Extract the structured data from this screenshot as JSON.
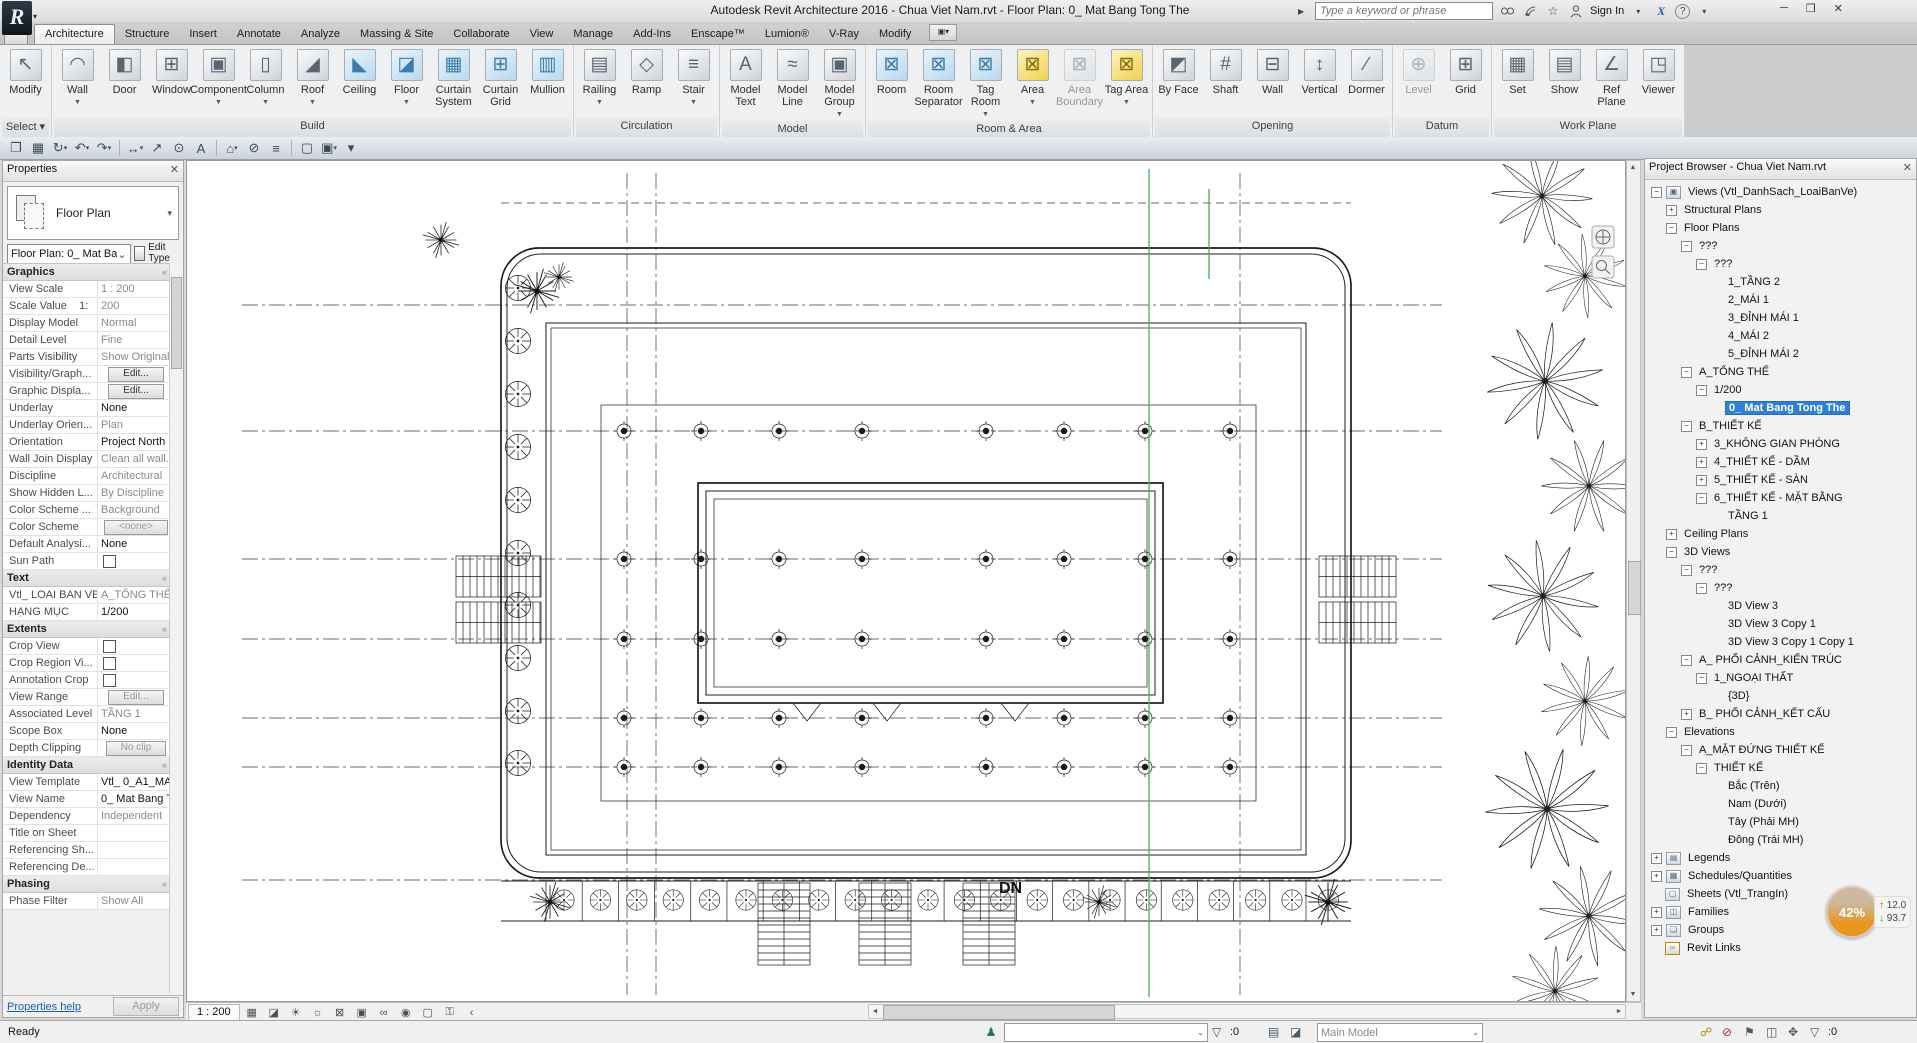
{
  "window": {
    "title": "Autodesk Revit Architecture 2016 -    Chua Viet Nam.rvt - Floor Plan: 0_ Mat Bang Tong The",
    "app_button": "R",
    "app_button_small": "A",
    "search_placeholder": "Type a keyword or phrase",
    "sign_in": "Sign In",
    "exchange_label": "X",
    "help_label": "?",
    "minimize": "─",
    "restore": "❐",
    "close": "✕"
  },
  "tabs": [
    {
      "label": "Architecture",
      "active": true
    },
    {
      "label": "Structure"
    },
    {
      "label": "Insert"
    },
    {
      "label": "Annotate"
    },
    {
      "label": "Analyze"
    },
    {
      "label": "Massing & Site"
    },
    {
      "label": "Collaborate"
    },
    {
      "label": "View"
    },
    {
      "label": "Manage"
    },
    {
      "label": "Add-Ins"
    },
    {
      "label": "Enscape™"
    },
    {
      "label": "Lumion®"
    },
    {
      "label": "V-Ray"
    },
    {
      "label": "Modify"
    }
  ],
  "qat": [
    {
      "name": "open-icon",
      "glyph": "❐"
    },
    {
      "name": "save-icon",
      "glyph": "▦"
    },
    {
      "name": "sync-icon",
      "glyph": "↻",
      "arrow": true
    },
    {
      "name": "undo-icon",
      "glyph": "↶",
      "arrow": true
    },
    {
      "name": "redo-icon",
      "glyph": "↷",
      "arrow": true
    },
    {
      "name": "measure-icon",
      "glyph": "↔",
      "arrow": true
    },
    {
      "name": "aligned-dimension-icon",
      "glyph": "↗"
    },
    {
      "name": "tag-icon",
      "glyph": "⊙"
    },
    {
      "name": "text-icon",
      "glyph": "A"
    },
    {
      "name": "default-3d-view-icon",
      "glyph": "⌂",
      "arrow": true
    },
    {
      "name": "section-icon",
      "glyph": "⊘"
    },
    {
      "name": "thin-lines-icon",
      "glyph": "≡"
    },
    {
      "name": "close-hidden-windows-icon",
      "glyph": "▢"
    },
    {
      "name": "switch-windows-icon",
      "glyph": "▣",
      "arrow": true
    },
    {
      "name": "customize-qat-icon",
      "glyph": "▾"
    }
  ],
  "ribbon": {
    "groups": [
      {
        "label": "Select",
        "arrow": true,
        "buttons": [
          {
            "label": "Modify",
            "glyph": "↖"
          }
        ]
      },
      {
        "label": "Build",
        "buttons": [
          {
            "label": "Wall",
            "glyph": "◠",
            "arrow": true
          },
          {
            "label": "Door",
            "glyph": "◧"
          },
          {
            "label": "Window",
            "glyph": "⊞"
          },
          {
            "label": "Component",
            "glyph": "▣",
            "arrow": true
          },
          {
            "label": "Column",
            "glyph": "▯",
            "arrow": true
          },
          {
            "label": "Roof",
            "glyph": "◢",
            "arrow": true
          },
          {
            "label": "Ceiling",
            "glyph": "◣",
            "tone": "blue"
          },
          {
            "label": "Floor",
            "glyph": "◪",
            "tone": "blue",
            "arrow": true
          },
          {
            "label": "Curtain System",
            "glyph": "▦",
            "tone": "blue"
          },
          {
            "label": "Curtain Grid",
            "glyph": "⊞",
            "tone": "blue"
          },
          {
            "label": "Mullion",
            "glyph": "▥",
            "tone": "blue"
          }
        ]
      },
      {
        "label": "Circulation",
        "buttons": [
          {
            "label": "Railing",
            "glyph": "▤",
            "arrow": true
          },
          {
            "label": "Ramp",
            "glyph": "◇"
          },
          {
            "label": "Stair",
            "glyph": "≡",
            "arrow": true
          }
        ]
      },
      {
        "label": "Model",
        "buttons": [
          {
            "label": "Model Text",
            "glyph": "A"
          },
          {
            "label": "Model Line",
            "glyph": "≈"
          },
          {
            "label": "Model Group",
            "glyph": "▣",
            "arrow": true
          }
        ]
      },
      {
        "label": "Room & Area",
        "buttons": [
          {
            "label": "Room",
            "glyph": "⊠",
            "tone": "blue"
          },
          {
            "label": "Room Separator",
            "glyph": "⊠",
            "tone": "blue"
          },
          {
            "label": "Tag Room",
            "glyph": "⊠",
            "tone": "blue",
            "arrow": true
          },
          {
            "label": "Area",
            "glyph": "⊠",
            "tone": "yellow",
            "arrow": true
          },
          {
            "label": "Area Boundary",
            "glyph": "⊠",
            "disabled": true
          },
          {
            "label": "Tag Area",
            "glyph": "⊠",
            "tone": "yellow",
            "arrow": true
          }
        ]
      },
      {
        "label": "Opening",
        "buttons": [
          {
            "label": "By Face",
            "glyph": "◩"
          },
          {
            "label": "Shaft",
            "glyph": "#"
          },
          {
            "label": "Wall",
            "glyph": "⊟"
          },
          {
            "label": "Vertical",
            "glyph": "↕"
          },
          {
            "label": "Dormer",
            "glyph": "∕"
          }
        ]
      },
      {
        "label": "Datum",
        "buttons": [
          {
            "label": "Level",
            "glyph": "⊕",
            "disabled": true
          },
          {
            "label": "Grid",
            "glyph": "⊞"
          }
        ]
      },
      {
        "label": "Work Plane",
        "buttons": [
          {
            "label": "Set",
            "glyph": "▦"
          },
          {
            "label": "Show",
            "glyph": "▤"
          },
          {
            "label": "Ref Plane",
            "glyph": "∠"
          },
          {
            "label": "Viewer",
            "glyph": "◳"
          }
        ]
      }
    ]
  },
  "properties": {
    "title": "Properties",
    "close": "✕",
    "type_label": "Floor Plan",
    "selector": "Floor Plan: 0_ Mat Ba",
    "selector_arrow": "⌄",
    "edit_type": "Edit Type",
    "help": "Properties help",
    "apply": "Apply",
    "sections": [
      {
        "header": "Graphics",
        "rows": [
          {
            "label": "View Scale",
            "value": "1 : 200",
            "muted": true
          },
          {
            "label": "Scale Value    1:",
            "value": "200",
            "muted": true
          },
          {
            "label": "Display Model",
            "value": "Normal",
            "muted": true
          },
          {
            "label": "Detail Level",
            "value": "Fine",
            "muted": true
          },
          {
            "label": "Parts Visibility",
            "value": "Show Original",
            "muted": true
          },
          {
            "label": "Visibility/Graph...",
            "value": "Edit...",
            "type": "button"
          },
          {
            "label": "Graphic Displa...",
            "value": "Edit...",
            "type": "button"
          },
          {
            "label": "Underlay",
            "value": "None"
          },
          {
            "label": "Underlay Orien...",
            "value": "Plan",
            "muted": true
          },
          {
            "label": "Orientation",
            "value": "Project North"
          },
          {
            "label": "Wall Join Display",
            "value": "Clean all wall...",
            "muted": true
          },
          {
            "label": "Discipline",
            "value": "Architectural",
            "muted": true
          },
          {
            "label": "Show Hidden L...",
            "value": "By Discipline",
            "muted": true
          },
          {
            "label": "Color Scheme ...",
            "value": "Background",
            "muted": true
          },
          {
            "label": "Color Scheme",
            "value": "<none>",
            "type": "button",
            "muted": true
          },
          {
            "label": "Default Analysi...",
            "value": "None"
          },
          {
            "label": "Sun Path",
            "value": "",
            "type": "checkbox"
          }
        ]
      },
      {
        "header": "Text",
        "rows": [
          {
            "label": "Vtl_ LOAI BAN VE",
            "value": "A_TỔNG THỂ",
            "muted": true
          },
          {
            "label": "HẠNG MỤC",
            "value": "1/200"
          }
        ]
      },
      {
        "header": "Extents",
        "rows": [
          {
            "label": "Crop View",
            "value": "",
            "type": "checkbox"
          },
          {
            "label": "Crop Region Vi...",
            "value": "",
            "type": "checkbox"
          },
          {
            "label": "Annotation Crop",
            "value": "",
            "type": "checkbox"
          },
          {
            "label": "View Range",
            "value": "Edit...",
            "type": "button",
            "muted": true
          },
          {
            "label": "Associated Level",
            "value": "TẦNG 1",
            "muted": true
          },
          {
            "label": "Scope Box",
            "value": "None"
          },
          {
            "label": "Depth Clipping",
            "value": "No clip",
            "type": "button",
            "muted": true
          }
        ]
      },
      {
        "header": "Identity Data",
        "rows": [
          {
            "label": "View Template",
            "value": "Vtl_ 0_A1_MAT BA"
          },
          {
            "label": "View Name",
            "value": "0_ Mat Bang To..."
          },
          {
            "label": "Dependency",
            "value": "Independent",
            "muted": true
          },
          {
            "label": "Title on Sheet",
            "value": ""
          },
          {
            "label": "Referencing Sh...",
            "value": "",
            "muted": true
          },
          {
            "label": "Referencing De...",
            "value": "",
            "muted": true
          }
        ]
      },
      {
        "header": "Phasing",
        "rows": [
          {
            "label": "Phase Filter",
            "value": "Show All",
            "muted": true
          }
        ]
      }
    ]
  },
  "viewbar": {
    "scale": "1 : 200",
    "icons": [
      {
        "name": "visual-style-icon",
        "glyph": "▦"
      },
      {
        "name": "detail-level-icon",
        "glyph": "◪"
      },
      {
        "name": "sun-path-off-icon",
        "glyph": "☀"
      },
      {
        "name": "shadows-off-icon",
        "glyph": "☼"
      },
      {
        "name": "crop-view-off-icon",
        "glyph": "⊠"
      },
      {
        "name": "show-crop-region-icon",
        "glyph": "▣"
      },
      {
        "name": "reveal-hidden-elements-icon",
        "glyph": "∞"
      },
      {
        "name": "temporary-hide-isolate-icon",
        "glyph": "◉"
      },
      {
        "name": "worksharing-display-icon",
        "glyph": "▢"
      },
      {
        "name": "reveal-constraints-icon",
        "glyph": "⚿"
      },
      {
        "name": "collapse-icon",
        "glyph": "‹"
      }
    ]
  },
  "canvas": {
    "dn_label": "DN"
  },
  "browser": {
    "title": "Project Browser - Chua Viet Nam.rvt",
    "close": "✕",
    "glyph_plus": "+",
    "glyph_minus": "−",
    "items": [
      {
        "label": "Views (Vtl_DanhSach_LoaiBanVe)",
        "depth": 0,
        "box": "minus",
        "icon": "views"
      },
      {
        "label": "Structural Plans",
        "depth": 1,
        "box": "plus"
      },
      {
        "label": "Floor Plans",
        "depth": 1,
        "box": "minus"
      },
      {
        "label": "???",
        "depth": 2,
        "box": "minus"
      },
      {
        "label": "???",
        "depth": 3,
        "box": "minus"
      },
      {
        "label": "1_TẦNG 2",
        "depth": 4
      },
      {
        "label": "2_MÁI 1",
        "depth": 4
      },
      {
        "label": "3_ĐỈNH MÁI 1",
        "depth": 4
      },
      {
        "label": "4_MÁI 2",
        "depth": 4
      },
      {
        "label": "5_ĐỈNH MÁI 2",
        "depth": 4
      },
      {
        "label": "A_TỔNG THỂ",
        "depth": 2,
        "box": "minus"
      },
      {
        "label": "1/200",
        "depth": 3,
        "box": "minus"
      },
      {
        "label": "0_ Mat Bang Tong The",
        "depth": 4,
        "selected": true
      },
      {
        "label": "B_THIẾT KẾ",
        "depth": 2,
        "box": "minus"
      },
      {
        "label": "3_KHÔNG GIAN PHÒNG",
        "depth": 3,
        "box": "plus"
      },
      {
        "label": "4_THIẾT KẾ - DẦM",
        "depth": 3,
        "box": "plus"
      },
      {
        "label": "5_THIẾT KẾ - SÀN",
        "depth": 3,
        "box": "plus"
      },
      {
        "label": "6_THIẾT KẾ - MẶT BẰNG",
        "depth": 3,
        "box": "minus"
      },
      {
        "label": "TẦNG 1",
        "depth": 4
      },
      {
        "label": "Ceiling Plans",
        "depth": 1,
        "box": "plus"
      },
      {
        "label": "3D Views",
        "depth": 1,
        "box": "minus"
      },
      {
        "label": "???",
        "depth": 2,
        "box": "minus"
      },
      {
        "label": "???",
        "depth": 3,
        "box": "minus"
      },
      {
        "label": "3D View 3",
        "depth": 4
      },
      {
        "label": "3D View 3 Copy 1",
        "depth": 4
      },
      {
        "label": "3D View 3 Copy 1 Copy 1",
        "depth": 4
      },
      {
        "label": "A_ PHỐI CẢNH_KIẾN TRÚC",
        "depth": 2,
        "box": "minus"
      },
      {
        "label": "1_NGOẠI THẤT",
        "depth": 3,
        "box": "minus"
      },
      {
        "label": "{3D}",
        "depth": 4
      },
      {
        "label": "B_ PHỐI CẢNH_KẾT CẤU",
        "depth": 2,
        "box": "plus"
      },
      {
        "label": "Elevations",
        "depth": 1,
        "box": "minus"
      },
      {
        "label": "A_MẶT ĐỨNG THIẾT KẾ",
        "depth": 2,
        "box": "minus"
      },
      {
        "label": "THIẾT KẾ",
        "depth": 3,
        "box": "minus"
      },
      {
        "label": "Bắc (Trên)",
        "depth": 4
      },
      {
        "label": "Nam (Dưới)",
        "depth": 4
      },
      {
        "label": "Tây (Phải MH)",
        "depth": 4
      },
      {
        "label": "Đông (Trái MH)",
        "depth": 4
      },
      {
        "label": "Legends",
        "depth": 0,
        "box": "plus",
        "icon": "legends"
      },
      {
        "label": "Schedules/Quantities",
        "depth": 0,
        "box": "plus",
        "icon": "schedules"
      },
      {
        "label": "Sheets (Vtl_TrangIn)",
        "depth": 0,
        "icon": "sheets"
      },
      {
        "label": "Families",
        "depth": 0,
        "box": "plus",
        "icon": "families"
      },
      {
        "label": "Groups",
        "depth": 0,
        "box": "plus",
        "icon": "groups"
      },
      {
        "label": "Revit Links",
        "depth": 0,
        "icon": "links"
      }
    ]
  },
  "statusbar": {
    "ready": "Ready",
    "worker_glyph": "♟",
    "workset_value": "",
    "filter_count": ":0",
    "main_model": "Main Model",
    "selection_count": ":0",
    "icons_mid": [
      {
        "name": "editing-requests-icon",
        "glyph": "▤"
      },
      {
        "name": "worksets-dialog-icon",
        "glyph": "◪"
      }
    ],
    "icons_right": [
      {
        "name": "select-links-icon",
        "glyph": "☍"
      },
      {
        "name": "select-underlay-icon",
        "glyph": "⊘"
      },
      {
        "name": "select-pinned-icon",
        "glyph": "⚑"
      },
      {
        "name": "select-by-face-icon",
        "glyph": "◫"
      },
      {
        "name": "drag-on-selection-icon",
        "glyph": "✥"
      },
      {
        "name": "selection-filter-icon",
        "glyph": "▽"
      }
    ]
  },
  "widget": {
    "percent": "42%",
    "up_value": "12.0",
    "down_value": "93.7"
  }
}
